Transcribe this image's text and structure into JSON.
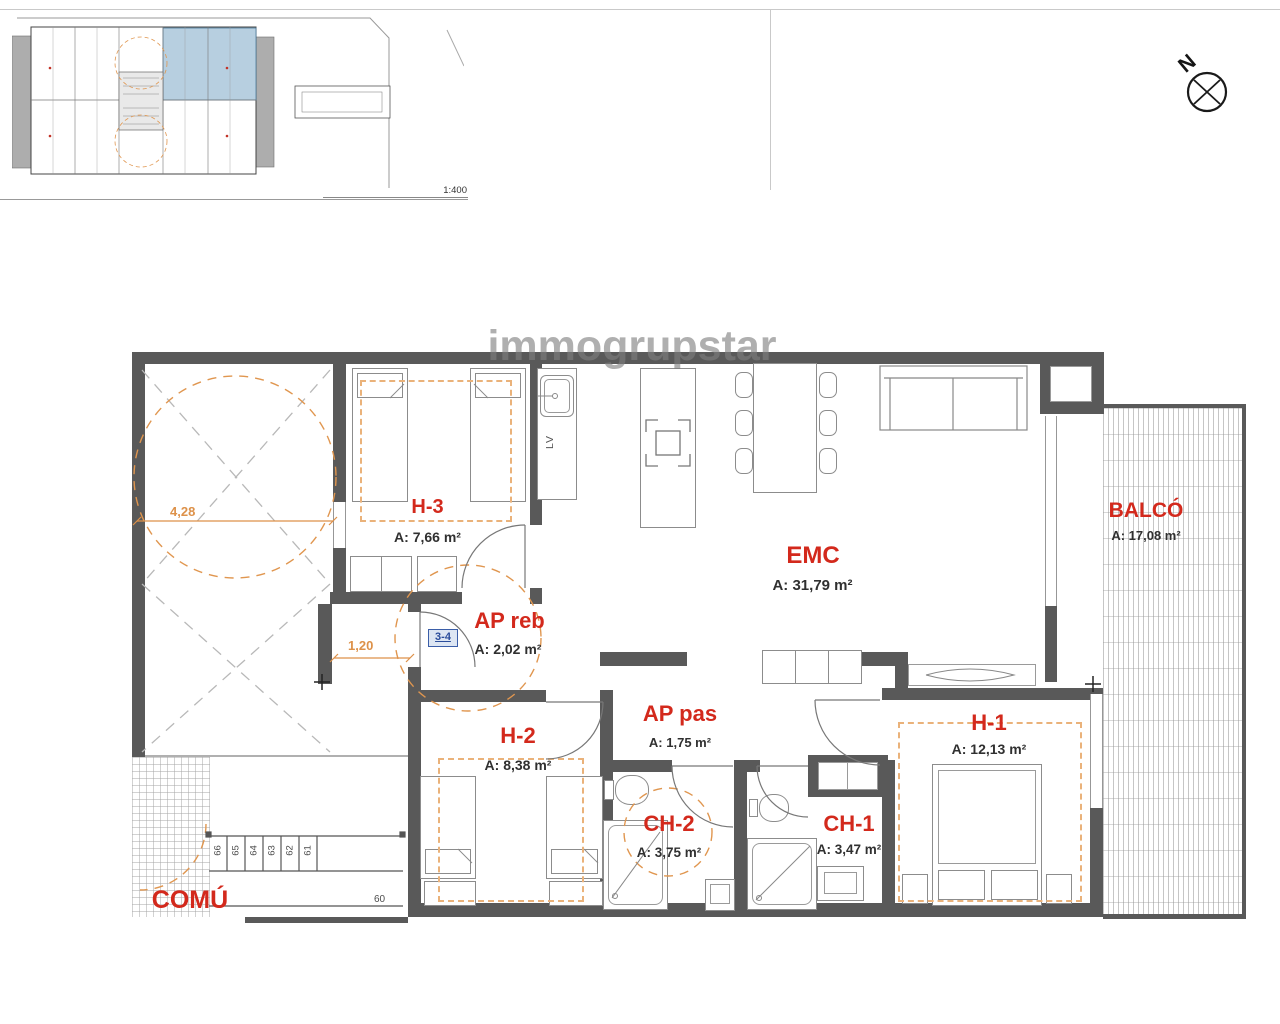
{
  "watermark": "immogrupstar",
  "north": {
    "label": "N"
  },
  "site_plan": {
    "scale_label": "1:400"
  },
  "unit_badge": "3-4",
  "rooms": {
    "h3": {
      "name": "H-3",
      "area": "A: 7,66 m²"
    },
    "ap_reb": {
      "name": "AP reb",
      "area": "A: 2,02 m²"
    },
    "emc": {
      "name": "EMC",
      "area": "A: 31,79 m²"
    },
    "balco": {
      "name": "BALCÓ",
      "area": "A: 17,08 m²"
    },
    "h2": {
      "name": "H-2",
      "area": "A: 8,38 m²"
    },
    "ap_pas": {
      "name": "AP pas",
      "area": "A: 1,75 m²"
    },
    "ch2": {
      "name": "CH-2",
      "area": "A: 3,75 m²"
    },
    "ch1": {
      "name": "CH-1",
      "area": "A: 3,47 m²"
    },
    "h1": {
      "name": "H-1",
      "area": "A: 12,13 m²"
    },
    "comu": {
      "name": "COMÚ"
    }
  },
  "dimensions": {
    "patio_width": "4,28",
    "hall_width": "1,20"
  },
  "stairs": {
    "treads": [
      "66",
      "65",
      "64",
      "63",
      "62",
      "61"
    ],
    "bottom_tread": "60"
  },
  "kitchen": {
    "appliance_label": "LV"
  },
  "colors": {
    "label_red": "#d3291c",
    "dim_orange": "#e0964f",
    "wall_gray": "#595959",
    "ref_blue": "#2b4d9b",
    "highlight_unit": "#b7cfe0"
  }
}
